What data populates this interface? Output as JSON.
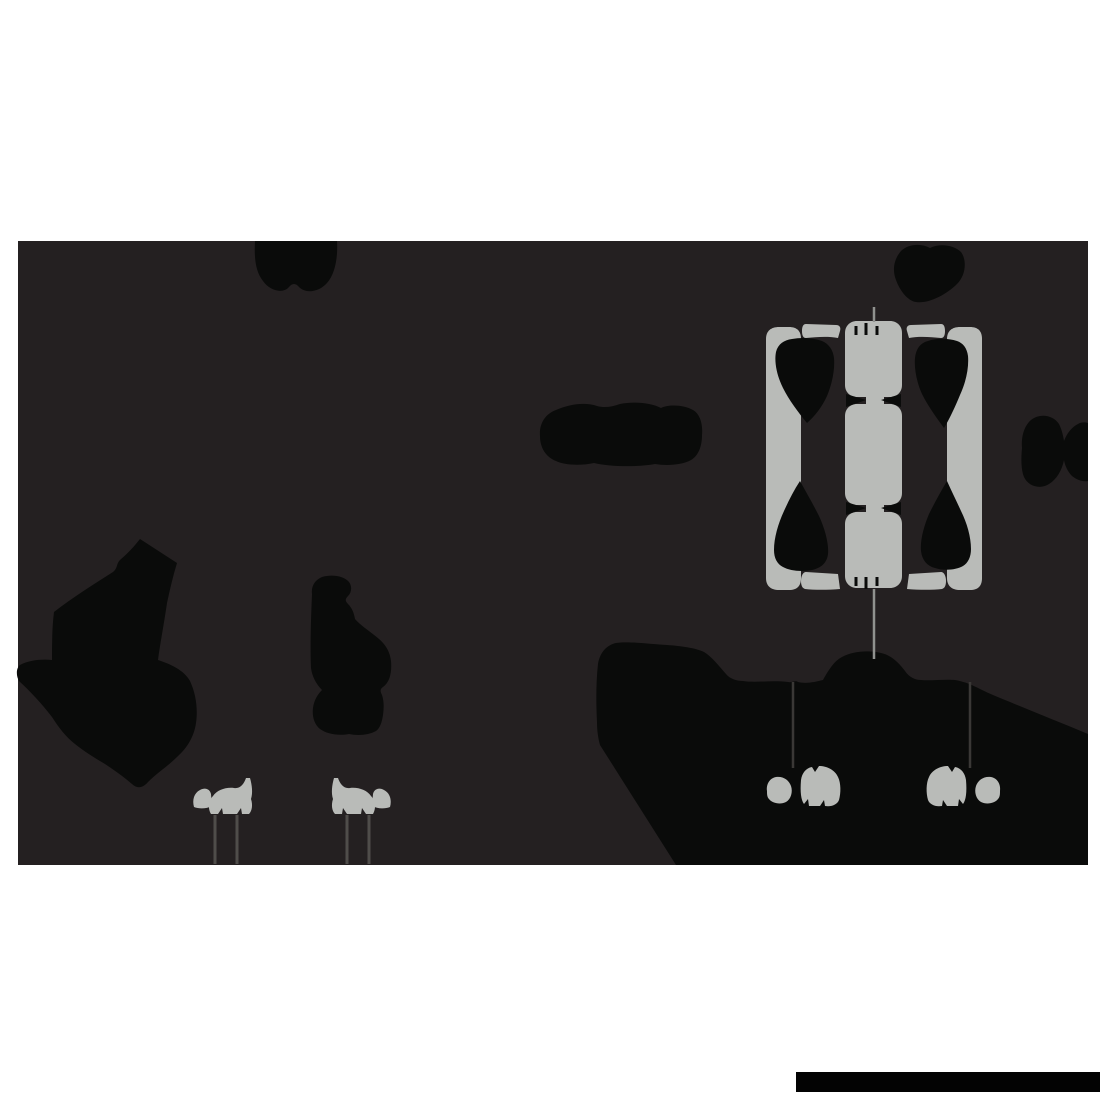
{
  "canvas": {
    "width": 1100,
    "height": 1100,
    "background": "#ffffff"
  },
  "palette": {
    "white": "#ffffff",
    "backdrop_dark": "#242021",
    "silhouette_black": "#0a0b0a",
    "shape_gray": "#b9bbb8",
    "stilt_line_gray": "#4f4d4a",
    "hang_line_gray": "#3a3836",
    "string_gray": "#90928f",
    "bar_black": "#030303"
  },
  "paths": {
    "backdrop": {
      "d": "M18,241 H1088 V865 H18 Z"
    },
    "swag": {
      "d": "M255,241 C254,260 256,272 263,281 C270,291 283,294 289,287 C292,283 296,283 299,287 C306,294 319,292 327,283 C335,274 338,258 337,241 Z"
    },
    "top_blob": {
      "d": "M901,251 C894,259 892,270 896,280 C900,291 908,301 916,302 C928,304 946,295 957,284 C966,275 967,260 961,252 C954,245 940,243 930,248 C921,243 908,244 901,251 Z"
    },
    "lying_blob": {
      "d": "M540,436 C539,424 545,414 556,410 C570,404 585,402 597,406 C604,408 612,407 620,404 C634,401 652,403 661,408 C669,404 684,405 693,410 C700,414 703,424 702,435 C702,447 698,456 691,460 C682,465 667,466 655,464 C639,467 610,467 594,463 C580,466 564,465 556,461 C546,457 540,448 540,436 Z"
    },
    "bowtie": {
      "d": "M1022,448 C1021,437 1024,426 1031,420 C1040,413 1053,415 1059,424 C1061,428 1063,434 1064,441 C1067,433 1072,427 1078,424 C1081,422 1085,422 1088,423 L1088,481 C1083,482 1077,480 1072,476 C1068,472 1065,466 1064,460 C1062,470 1057,479 1049,484 C1040,490 1028,486 1024,477 C1021,470 1021,458 1022,448 Z"
    },
    "left_silhouette": {
      "d": "M140,539 C133,548 127,554 120,560 C116,564 118,568 113,572 C94,584 72,598 54,612 C52,628 52,644 52,660 C42,659 29,660 20,665 C16,668 16,676 19,681 C30,691 42,704 52,717 C59,728 66,737 75,744 C85,752 95,758 105,764 C114,770 124,777 132,784 C137,789 143,788 148,782 C157,773 168,766 177,757 C187,748 194,737 196,723 C198,709 196,694 190,681 C184,670 170,664 158,660 C160,644 163,630 167,603 C170,589 173,576 177,563 Z"
    },
    "standing_figure": {
      "d": "M312,594 C311,586 315,580 322,577 C332,574 344,576 349,582 C352,586 352,592 348,596 C345,599 345,601 348,604 C352,608 354,613 355,619 C361,626 371,632 379,639 C386,645 390,652 391,661 C392,672 390,682 383,687 C380,689 380,691 382,695 C384,701 384,708 383,715 C382,722 380,728 376,731 C369,735 358,736 349,734 C338,736 327,734 320,729 C314,724 312,716 313,708 C314,700 318,694 322,690 C316,684 312,676 311,668 C310,645 311,618 312,594 Z"
    },
    "mound": {
      "d": "M676,865 L600,745 C598,738 597,730 597,722 C596,702 596,682 598,664 C600,652 607,645 616,643 C628,641 650,644 667,645 C681,646 696,648 704,652 C712,657 719,666 726,674 C730,679 737,681 743,681 C756,683 771,680 788,682 C792,683 795,680 798,682 C806,684 815,682 823,680 C828,671 834,661 842,657 C853,651 869,650 881,653 C891,655 899,663 905,671 C909,677 915,680 921,680 C930,681 945,679 955,680 C966,682 972,685 980,689 C990,694 1000,698 1010,702 C1036,713 1062,723 1088,734 L1088,865 Z"
    },
    "window": {
      "bar_left": {
        "d": "M766,339 C766,331 771,327 779,327 L789,327 C797,327 801,331 801,339 L801,578 C801,586 797,590 789,590 L779,590 C771,590 766,586 766,578 Z"
      },
      "bar_right": {
        "d": "M947,339 C947,331 952,327 960,327 L970,327 C978,327 982,331 982,339 L982,578 C982,586 978,590 970,590 L960,590 C952,590 947,586 947,578 Z"
      },
      "shoulder_left": {
        "d": "M806,324 L836,325 C840,325 841,328 840,331 L838,338 C828,336 816,337 806,338 C803,338 802,335 802,331 C802,327 803,324 806,324 Z"
      },
      "shoulder_right": {
        "d": "M941,324 L911,325 C907,325 906,328 907,331 L909,338 C919,336 931,337 941,338 C944,338 945,335 945,331 C945,327 944,324 941,324 Z"
      },
      "foot_left": {
        "d": "M806,572 L838,574 L840,589 C828,590 814,590 805,589 C802,588 801,585 801,581 C801,576 803,572 806,572 Z"
      },
      "foot_right": {
        "d": "M941,572 L909,574 L907,589 C919,590 933,590 942,589 C945,588 946,585 946,581 C946,576 944,572 941,572 Z"
      },
      "segment_top": {
        "d": "M845,333 C845,326 850,321 857,321 L890,321 C897,321 902,326 902,333 L902,385 C902,392 897,397 890,397 L857,397 C850,397 845,392 845,385 Z"
      },
      "segment_mid": {
        "d": "M845,416 C845,409 850,404 857,404 L890,404 C897,404 902,409 902,416 L902,493 C902,500 897,505 890,505 L857,505 C850,505 845,500 845,493 Z"
      },
      "segment_bottom": {
        "d": "M845,524 C845,517 850,512 857,512 L890,512 C897,512 902,517 902,524 L902,576 C902,583 897,588 890,588 L857,588 C850,588 845,583 845,576 Z"
      },
      "neck": {
        "d": "M866,392 H884 V518 H866 Z"
      },
      "teardrop_tl": {
        "d": "M807,423 C798,412 789,400 783,388 C777,376 774,362 776,352 C778,344 784,340 792,339 C802,337 814,338 822,341 C829,344 833,350 834,358 C835,370 832,384 827,396 C822,407 815,416 807,423 Z"
      },
      "teardrop_tr": {
        "d": "M944,428 C936,417 928,406 922,394 C917,383 914,369 915,358 C916,349 920,343 928,341 C936,338 948,338 957,341 C963,343 967,348 968,356 C969,368 966,382 960,395 C955,407 950,418 944,428 Z"
      },
      "teardrop_bl": {
        "d": "M800,481 C806,492 813,504 819,516 C825,529 829,544 828,554 C827,563 821,568 812,570 C802,572 790,571 783,567 C777,564 774,558 774,550 C774,538 778,524 784,511 C789,500 794,490 800,481 Z"
      },
      "teardrop_br": {
        "d": "M947,481 C941,491 935,502 929,514 C924,526 920,540 921,551 C922,560 927,566 935,568 C944,571 956,570 963,566 C968,563 971,557 971,549 C971,537 967,523 961,511 C956,500 951,490 947,481 Z"
      },
      "wedge_tl": {
        "d": "M846,394 L866,400 L846,407 Z"
      },
      "wedge_tr": {
        "d": "M901,394 L881,400 L901,407 Z"
      },
      "wedge_bl": {
        "d": "M846,502 L866,508 L846,515 Z"
      },
      "wedge_br": {
        "d": "M901,502 L881,508 L901,515 Z"
      },
      "ticks_top": {
        "d": "M856,326 L856,335 M866,323 L866,335 M877,326 L877,335",
        "w": "3"
      },
      "ticks_bottom": {
        "d": "M856,577 L856,586 M866,577 L866,589 M877,577 L877,586",
        "w": "3"
      },
      "string_top": {
        "d": "M874,307 L874,322",
        "w": "2.5"
      },
      "string_bottom": {
        "d": "M874,589 L874,659",
        "w": "2.5"
      }
    },
    "hangers": {
      "line_left": {
        "d": "M793,682 L793,768",
        "w": "2.5"
      },
      "line_right": {
        "d": "M970,682 L970,768",
        "w": "2.5"
      },
      "small_left": {
        "d": "M767,791 C766,784 770,778 776,777 C783,776 789,780 791,786 C793,792 791,799 786,802 C780,805 772,803 769,799 C767,797 767,794 767,791 Z"
      },
      "big_left": {
        "d": "M801,780 C802,773 806,768 812,767 L815,772 L819,766 C827,766 835,770 838,777 C841,783 841,793 839,800 C837,805 831,807 825,806 L824,800 L820,806 L809,806 L808,799 L804,804 C801,800 800,792 801,780 Z"
      },
      "big_right": {
        "d": "M966,780 C965,773 961,768 955,767 L952,772 L948,766 C940,766 932,770 929,777 C926,783 926,793 928,800 C930,805 936,807 942,806 L943,800 L947,806 L958,806 L959,799 L963,804 C966,800 967,792 966,780 Z"
      },
      "small_right": {
        "d": "M1000,791 C1001,784 997,778 991,777 C984,776 978,780 976,786 C974,792 976,799 981,802 C987,805 995,803 998,799 C1000,797 1000,794 1000,791 Z"
      }
    },
    "perched": {
      "triangle_left": {
        "d": "M194,807 C192,800 194,793 200,790 C205,787 210,789 211,794 L212,806 C206,809 199,809 194,807 Z"
      },
      "animal_left": {
        "d": "M213,796 C217,790 226,787 234,788 C240,789 244,784 246,778 L250,778 C252,785 253,793 251,799 C253,805 252,811 249,814 L242,814 L241,808 L237,814 L223,814 L222,808 L218,814 L211,814 C208,809 208,801 213,796 Z"
      },
      "animal_right": {
        "d": "M371,796 C367,790 358,787 350,788 C344,789 340,784 338,778 L334,778 C332,785 331,793 333,799 C331,805 332,811 335,814 L342,814 L343,808 L347,814 L361,814 L362,808 L366,814 L373,814 C376,809 376,801 371,796 Z"
      },
      "triangle_right": {
        "d": "M390,807 C392,800 390,793 384,790 C379,787 374,789 373,794 L372,806 C378,809 385,809 390,807 Z"
      },
      "stilts_left": {
        "d": "M215,815 L215,864 M237,815 L237,864",
        "w": "3"
      },
      "stilts_right": {
        "d": "M347,815 L347,864 M369,815 L369,864",
        "w": "3"
      }
    },
    "watermark_bar": {
      "d": "M796,1072 H1100 V1092 H796 Z"
    }
  }
}
